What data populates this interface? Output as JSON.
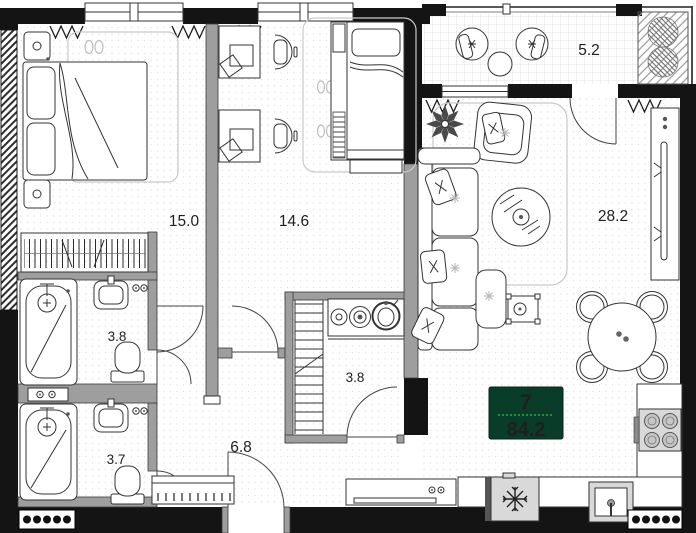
{
  "plan": {
    "unit_badge": {
      "number": "7",
      "area": "84.2"
    },
    "rooms": [
      {
        "id": "bedroom",
        "label": "15.0"
      },
      {
        "id": "kids-room",
        "label": "14.6"
      },
      {
        "id": "balcony",
        "label": "5.2"
      },
      {
        "id": "living-kitchen",
        "label": "28.2"
      },
      {
        "id": "bathroom-1",
        "label": "3.8"
      },
      {
        "id": "utility-room",
        "label": "3.8"
      },
      {
        "id": "bathroom-2",
        "label": "3.7"
      },
      {
        "id": "hallway",
        "label": "6.8"
      }
    ],
    "colors": {
      "badge_bg": "#0a3d29",
      "badge_number": "#2db84b",
      "badge_area": "#3fd45f",
      "badge_divider": "#1e8f3a"
    }
  }
}
